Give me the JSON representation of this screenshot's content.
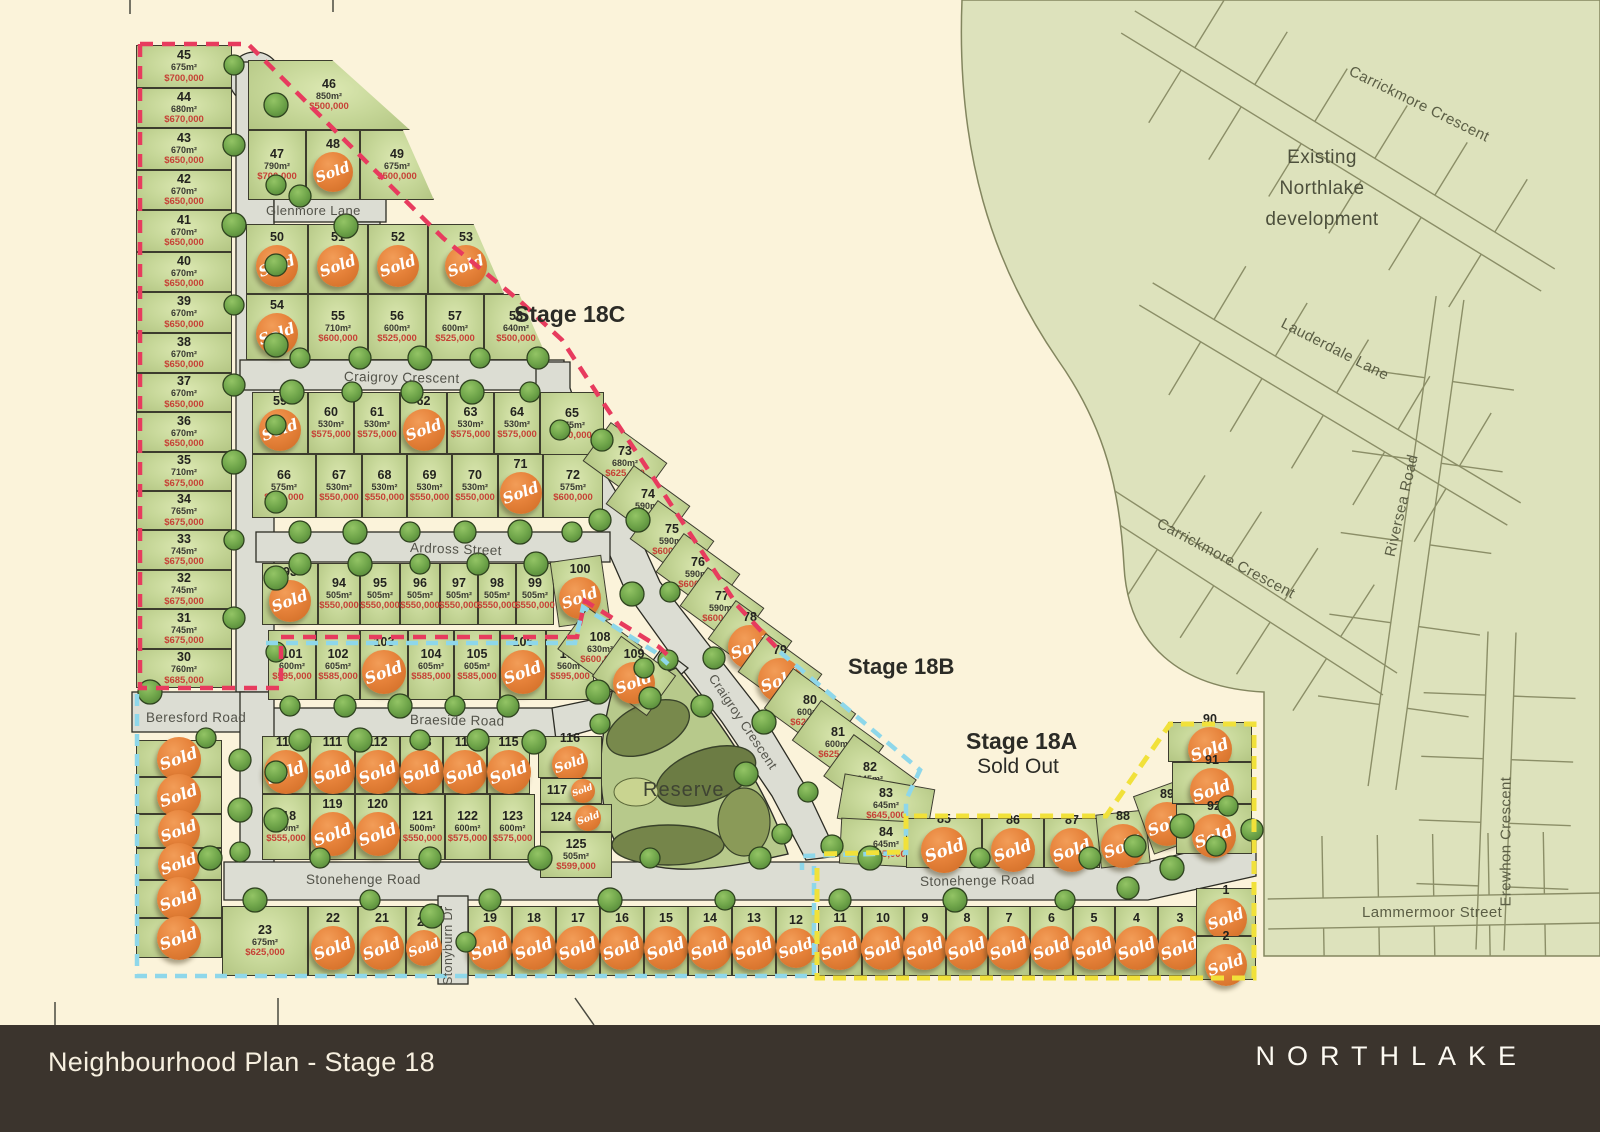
{
  "colors": {
    "background": "#fbf3da",
    "existing_area": "#dde2bc",
    "lot_green": "#c5d697",
    "road_grey": "#dcddd3",
    "red_dash": "#e73b5e",
    "cyan_dash": "#8ed7ea",
    "yellow_dash": "#f1e13a",
    "sold_badge": "#e6823a",
    "price_red": "#c64236",
    "footer_bg": "#3b342d"
  },
  "sold_label": "Sold",
  "footer": {
    "title": "Neighbourhood Plan - Stage 18",
    "brand": "NORTHLAKE"
  },
  "stages": {
    "c": {
      "label": "Stage 18C"
    },
    "b": {
      "label": "Stage 18B"
    },
    "a": {
      "label": "Stage 18A",
      "sub": "Sold Out"
    }
  },
  "areas": {
    "existing": {
      "line1": "Existing",
      "line2": "Northlake",
      "line3": "development"
    },
    "reserve": "Reserve"
  },
  "street_labels": [
    {
      "id": "glenmore",
      "text": "Glenmore Lane"
    },
    {
      "id": "craigroy-h",
      "text": "Craigroy Crescent"
    },
    {
      "id": "craigroy-d",
      "text": "Craigroy Crescent"
    },
    {
      "id": "ardross",
      "text": "Ardross Street"
    },
    {
      "id": "braeside",
      "text": "Braeside Road"
    },
    {
      "id": "beresford",
      "text": "Beresford Road"
    },
    {
      "id": "stonehenge-w",
      "text": "Stonehenge Road"
    },
    {
      "id": "stonehenge-e",
      "text": "Stonehenge Road"
    },
    {
      "id": "stonyburn",
      "text": "Stonyburn Dr"
    },
    {
      "id": "carrickmore-n",
      "text": "Carrickmore Crescent"
    },
    {
      "id": "lauderdale",
      "text": "Lauderdale Lane"
    },
    {
      "id": "carrickmore-s",
      "text": "Carrickmore Crescent"
    },
    {
      "id": "riversea",
      "text": "Riversea Road"
    },
    {
      "id": "erewhon",
      "text": "Erewhon Crescent"
    },
    {
      "id": "lammermoor",
      "text": "Lammermoor Street"
    }
  ],
  "lots": [
    {
      "id": "45",
      "num": "45",
      "area": "675m²",
      "price": "$700,000",
      "sold": false
    },
    {
      "id": "44",
      "num": "44",
      "area": "680m²",
      "price": "$670,000",
      "sold": false
    },
    {
      "id": "43",
      "num": "43",
      "area": "670m²",
      "price": "$650,000",
      "sold": false
    },
    {
      "id": "42",
      "num": "42",
      "area": "670m²",
      "price": "$650,000",
      "sold": false
    },
    {
      "id": "41",
      "num": "41",
      "area": "670m²",
      "price": "$650,000",
      "sold": false
    },
    {
      "id": "40",
      "num": "40",
      "area": "670m²",
      "price": "$650,000",
      "sold": false
    },
    {
      "id": "39",
      "num": "39",
      "area": "670m²",
      "price": "$650,000",
      "sold": false
    },
    {
      "id": "38",
      "num": "38",
      "area": "670m²",
      "price": "$650,000",
      "sold": false
    },
    {
      "id": "37",
      "num": "37",
      "area": "670m²",
      "price": "$650,000",
      "sold": false
    },
    {
      "id": "36",
      "num": "36",
      "area": "670m²",
      "price": "$650,000",
      "sold": false
    },
    {
      "id": "35",
      "num": "35",
      "area": "710m²",
      "price": "$675,000",
      "sold": false
    },
    {
      "id": "34",
      "num": "34",
      "area": "765m²",
      "price": "$675,000",
      "sold": false
    },
    {
      "id": "33",
      "num": "33",
      "area": "745m²",
      "price": "$675,000",
      "sold": false
    },
    {
      "id": "32",
      "num": "32",
      "area": "745m²",
      "price": "$675,000",
      "sold": false
    },
    {
      "id": "31",
      "num": "31",
      "area": "745m²",
      "price": "$675,000",
      "sold": false
    },
    {
      "id": "30",
      "num": "30",
      "area": "760m²",
      "price": "$685,000",
      "sold": false
    },
    {
      "id": "46",
      "num": "46",
      "area": "850m²",
      "price": "$500,000",
      "sold": false
    },
    {
      "id": "47",
      "num": "47",
      "area": "790m²",
      "price": "$700,000",
      "sold": false
    },
    {
      "id": "48",
      "num": "48",
      "sold": true
    },
    {
      "id": "49",
      "num": "49",
      "area": "675m²",
      "price": "$500,000",
      "sold": false
    },
    {
      "id": "50",
      "num": "50",
      "sold": true
    },
    {
      "id": "51",
      "num": "51",
      "sold": true
    },
    {
      "id": "52",
      "num": "52",
      "sold": true
    },
    {
      "id": "53",
      "num": "53",
      "sold": true
    },
    {
      "id": "54",
      "num": "54",
      "sold": true
    },
    {
      "id": "55",
      "num": "55",
      "area": "710m²",
      "price": "$600,000",
      "sold": false
    },
    {
      "id": "56",
      "num": "56",
      "area": "600m²",
      "price": "$525,000",
      "sold": false
    },
    {
      "id": "57",
      "num": "57",
      "area": "600m²",
      "price": "$525,000",
      "sold": false
    },
    {
      "id": "58",
      "num": "58",
      "area": "640m²",
      "price": "$500,000",
      "sold": false
    },
    {
      "id": "59",
      "num": "59",
      "sold": true
    },
    {
      "id": "60",
      "num": "60",
      "area": "530m²",
      "price": "$575,000",
      "sold": false
    },
    {
      "id": "61",
      "num": "61",
      "area": "530m²",
      "price": "$575,000",
      "sold": false
    },
    {
      "id": "62",
      "num": "62",
      "sold": true
    },
    {
      "id": "63",
      "num": "63",
      "area": "530m²",
      "price": "$575,000",
      "sold": false
    },
    {
      "id": "64",
      "num": "64",
      "area": "530m²",
      "price": "$575,000",
      "sold": false
    },
    {
      "id": "65",
      "num": "65",
      "area": "575m²",
      "price": "$650,000",
      "sold": false
    },
    {
      "id": "66",
      "num": "66",
      "area": "575m²",
      "price": "$600,000",
      "sold": false
    },
    {
      "id": "67",
      "num": "67",
      "area": "530m²",
      "price": "$550,000",
      "sold": false
    },
    {
      "id": "68",
      "num": "68",
      "area": "530m²",
      "price": "$550,000",
      "sold": false
    },
    {
      "id": "69",
      "num": "69",
      "area": "530m²",
      "price": "$550,000",
      "sold": false
    },
    {
      "id": "70",
      "num": "70",
      "area": "530m²",
      "price": "$550,000",
      "sold": false
    },
    {
      "id": "71",
      "num": "71",
      "sold": true
    },
    {
      "id": "72",
      "num": "72",
      "area": "575m²",
      "price": "$600,000",
      "sold": false
    },
    {
      "id": "73",
      "num": "73",
      "area": "680m²",
      "price": "$625,000",
      "sold": false
    },
    {
      "id": "74",
      "num": "74",
      "area": "590m²",
      "price": "$600,000",
      "sold": false
    },
    {
      "id": "75",
      "num": "75",
      "area": "590m²",
      "price": "$600,000",
      "sold": false
    },
    {
      "id": "76",
      "num": "76",
      "area": "590m²",
      "price": "$600,000",
      "sold": false
    },
    {
      "id": "77",
      "num": "77",
      "area": "590m²",
      "price": "$600,000",
      "sold": false
    },
    {
      "id": "78",
      "num": "78",
      "sold": true
    },
    {
      "id": "79",
      "num": "79",
      "sold": true
    },
    {
      "id": "80",
      "num": "80",
      "area": "600m²",
      "price": "$625,000",
      "sold": false
    },
    {
      "id": "81",
      "num": "81",
      "area": "600m²",
      "price": "$625,000",
      "sold": false
    },
    {
      "id": "82",
      "num": "82",
      "area": "645m²",
      "price": "$645,000",
      "sold": false
    },
    {
      "id": "83",
      "num": "83",
      "area": "645m²",
      "price": "$645,000",
      "sold": false
    },
    {
      "id": "84",
      "num": "84",
      "area": "645m²",
      "price": "$645,000",
      "sold": false
    },
    {
      "id": "85",
      "num": "85",
      "sold": true
    },
    {
      "id": "86",
      "num": "86",
      "sold": true
    },
    {
      "id": "87",
      "num": "87",
      "sold": true
    },
    {
      "id": "88",
      "num": "88",
      "sold": true
    },
    {
      "id": "89",
      "num": "89",
      "sold": true
    },
    {
      "id": "90",
      "num": "90",
      "sold": true
    },
    {
      "id": "91",
      "num": "91",
      "sold": true
    },
    {
      "id": "92",
      "num": "92",
      "sold": true
    },
    {
      "id": "93",
      "num": "93",
      "sold": true
    },
    {
      "id": "94",
      "num": "94",
      "area": "505m²",
      "price": "$550,000",
      "sold": false
    },
    {
      "id": "95",
      "num": "95",
      "area": "505m²",
      "price": "$550,000",
      "sold": false
    },
    {
      "id": "96",
      "num": "96",
      "area": "505m²",
      "price": "$550,000",
      "sold": false
    },
    {
      "id": "97",
      "num": "97",
      "area": "505m²",
      "price": "$550,000",
      "sold": false
    },
    {
      "id": "98",
      "num": "98",
      "area": "505m²",
      "price": "$550,000",
      "sold": false
    },
    {
      "id": "99",
      "num": "99",
      "area": "505m²",
      "price": "$550,000",
      "sold": false
    },
    {
      "id": "100",
      "num": "100",
      "sold": true
    },
    {
      "id": "101",
      "num": "101",
      "area": "600m²",
      "price": "$595,000",
      "sold": false
    },
    {
      "id": "102",
      "num": "102",
      "area": "605m²",
      "price": "$585,000",
      "sold": false
    },
    {
      "id": "103",
      "num": "103",
      "sold": true
    },
    {
      "id": "104",
      "num": "104",
      "area": "605m²",
      "price": "$585,000",
      "sold": false
    },
    {
      "id": "105",
      "num": "105",
      "area": "605m²",
      "price": "$585,000",
      "sold": false
    },
    {
      "id": "106",
      "num": "106",
      "sold": true
    },
    {
      "id": "107",
      "num": "107",
      "area": "560m²",
      "price": "$595,000",
      "sold": false
    },
    {
      "id": "108",
      "num": "108",
      "area": "630m²",
      "price": "$600,000",
      "sold": false
    },
    {
      "id": "109",
      "num": "109",
      "sold": true
    },
    {
      "id": "110",
      "num": "110",
      "sold": true
    },
    {
      "id": "111",
      "num": "111",
      "sold": true
    },
    {
      "id": "112",
      "num": "112",
      "sold": true
    },
    {
      "id": "113",
      "num": "113",
      "sold": true
    },
    {
      "id": "114",
      "num": "114",
      "sold": true
    },
    {
      "id": "115",
      "num": "115",
      "sold": true
    },
    {
      "id": "116",
      "num": "116",
      "sold": true
    },
    {
      "id": "117",
      "num": "117",
      "sold": true
    },
    {
      "id": "118",
      "num": "118",
      "area": "530m²",
      "price": "$555,000",
      "sold": false
    },
    {
      "id": "119",
      "num": "119",
      "sold": true
    },
    {
      "id": "120",
      "num": "120",
      "sold": true
    },
    {
      "id": "121",
      "num": "121",
      "area": "500m²",
      "price": "$550,000",
      "sold": false
    },
    {
      "id": "122",
      "num": "122",
      "area": "600m²",
      "price": "$575,000",
      "sold": false
    },
    {
      "id": "123",
      "num": "123",
      "area": "600m²",
      "price": "$575,000",
      "sold": false
    },
    {
      "id": "124",
      "num": "124",
      "sold": true
    },
    {
      "id": "125",
      "num": "125",
      "area": "505m²",
      "price": "$599,000",
      "sold": false
    },
    {
      "id": "u1",
      "num": "",
      "sold": true
    },
    {
      "id": "u2",
      "num": "",
      "sold": true
    },
    {
      "id": "u3",
      "num": "",
      "sold": true
    },
    {
      "id": "u4",
      "num": "",
      "sold": true
    },
    {
      "id": "u5",
      "num": "",
      "sold": true
    },
    {
      "id": "u6",
      "num": "",
      "sold": true
    },
    {
      "id": "23",
      "num": "23",
      "area": "675m²",
      "price": "$625,000",
      "sold": false
    },
    {
      "id": "22",
      "num": "22",
      "sold": true
    },
    {
      "id": "21",
      "num": "21",
      "sold": true
    },
    {
      "id": "20",
      "num": "20",
      "sold": true
    },
    {
      "id": "19",
      "num": "19",
      "sold": true
    },
    {
      "id": "18",
      "num": "18",
      "sold": true
    },
    {
      "id": "17",
      "num": "17",
      "sold": true
    },
    {
      "id": "16",
      "num": "16",
      "sold": true
    },
    {
      "id": "15",
      "num": "15",
      "sold": true
    },
    {
      "id": "14",
      "num": "14",
      "sold": true
    },
    {
      "id": "13",
      "num": "13",
      "sold": true
    },
    {
      "id": "12",
      "num": "12",
      "sold": true
    },
    {
      "id": "11",
      "num": "11",
      "sold": true
    },
    {
      "id": "10",
      "num": "10",
      "sold": true
    },
    {
      "id": "9",
      "num": "9",
      "sold": true
    },
    {
      "id": "8",
      "num": "8",
      "sold": true
    },
    {
      "id": "7",
      "num": "7",
      "sold": true
    },
    {
      "id": "6",
      "num": "6",
      "sold": true
    },
    {
      "id": "5",
      "num": "5",
      "sold": true
    },
    {
      "id": "4",
      "num": "4",
      "sold": true
    },
    {
      "id": "3",
      "num": "3",
      "sold": true
    },
    {
      "id": "1",
      "num": "1",
      "sold": true
    },
    {
      "id": "2",
      "num": "2",
      "sold": true
    }
  ]
}
